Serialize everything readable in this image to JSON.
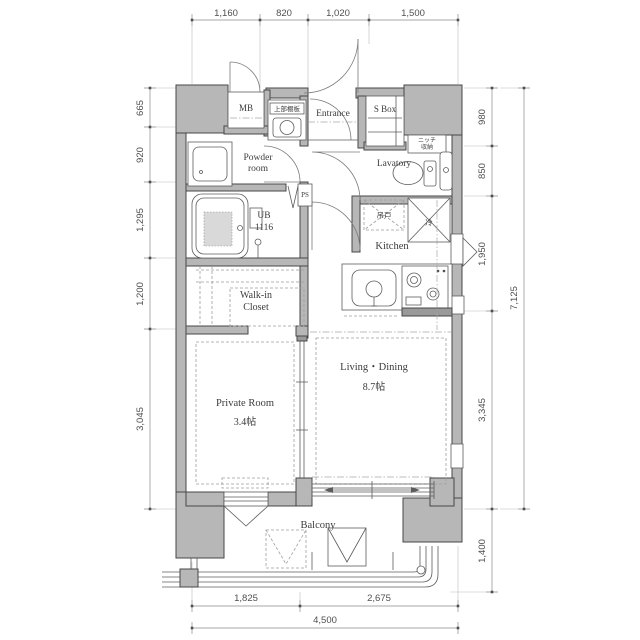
{
  "plan": {
    "rooms": {
      "mb": "MB",
      "upper_shelf": "上部棚板",
      "entrance": "Entrance",
      "s_box": "S Box",
      "powder_room": [
        "Powder",
        "room"
      ],
      "lavatory": "Lavatory",
      "niche": [
        "ニッチ",
        "収納"
      ],
      "ps": "PS",
      "unit_bath": [
        "UB",
        "1116"
      ],
      "hanging_cupboard": "吊戸",
      "refrigerator": "冷",
      "kitchen": "Kitchen",
      "walk_in_closet": [
        "Walk-in",
        "Closet"
      ],
      "private_room": [
        "Private Room",
        "3.4帖"
      ],
      "living_dining": [
        "Living・Dining",
        "8.7帖"
      ],
      "balcony": "Balcony"
    },
    "dimensions": {
      "top": [
        "1,160",
        "820",
        "1,020",
        "1,500"
      ],
      "left": [
        "665",
        "920",
        "1,295",
        "1,200",
        "3,045"
      ],
      "right": [
        "980",
        "850",
        "1,950",
        "3,345",
        "1,400"
      ],
      "right_total": "7,125",
      "bottom": [
        "1,825",
        "2,675"
      ],
      "bottom_total": "4,500"
    },
    "colors": {
      "wall_fill": "#b7b7b7",
      "wall_outline": "#474747",
      "fixture_line": "#5c5c5c",
      "dimension_text": "#4f4f4f",
      "background": "#ffffff"
    }
  }
}
